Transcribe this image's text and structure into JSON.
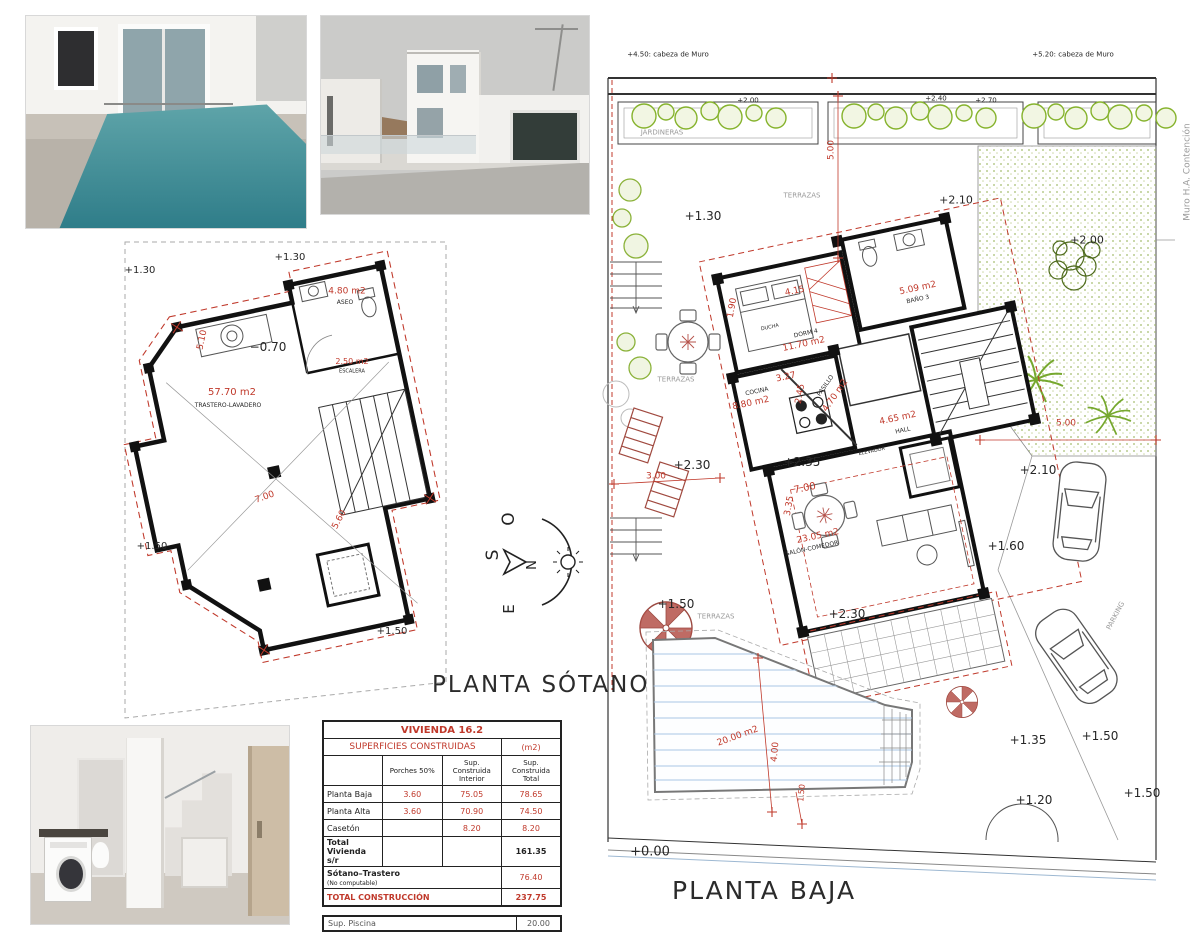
{
  "titles": {
    "sotano": "PLANTA SÓTANO",
    "baja": "PLANTA BAJA"
  },
  "compass": {
    "n": "N",
    "s": "S",
    "e": "E",
    "o": "O"
  },
  "colors": {
    "r": "#c0392b",
    "k": "#262626",
    "g2": "#9a9a9a"
  },
  "table": {
    "title": "VIVIENDA   16.2",
    "subtitle": "SUPERFICIES  CONSTRUIDAS",
    "subtitle_unit": "(m2)",
    "col_porches": "Porches  50%",
    "col_interior": "Sup. Construida Interior",
    "col_total": "Sup. Construida Total",
    "rows": [
      {
        "label": "Planta Baja",
        "porches": "3.60",
        "interior": "75.05",
        "total": "78.65"
      },
      {
        "label": "Planta Alta",
        "porches": "3.60",
        "interior": "70.90",
        "total": "74.50"
      },
      {
        "label": "Casetón",
        "porches": "",
        "interior": "8.20",
        "total": "8.20"
      }
    ],
    "total_vivienda_label": "Total Vivienda s/r",
    "total_vivienda_value": "161.35",
    "sotano_label": "Sótano–Trastero",
    "sotano_sublabel": "(No computable)",
    "sotano_value": "76.40",
    "total_label": "TOTAL  CONSTRUCCIÓN",
    "total_value": "237.75",
    "piscina_label": "Sup. Piscina",
    "piscina_value": "20.00",
    "footnote": "La vivienda ocupa sobre la parcela un área de 82.25 m2"
  },
  "sotano_labels": [
    {
      "t": "+1.30",
      "x": 140,
      "y": 271,
      "fs": 10
    },
    {
      "t": "+1.30",
      "x": 290,
      "y": 258,
      "fs": 10
    },
    {
      "t": "4.80 m2",
      "x": 347,
      "y": 292,
      "fs": 9,
      "c": "r"
    },
    {
      "t": "ASEO",
      "x": 345,
      "y": 303,
      "fs": 6
    },
    {
      "t": "−0.70",
      "x": 268,
      "y": 347,
      "fs": 12
    },
    {
      "t": "2.50 m2",
      "x": 352,
      "y": 362,
      "fs": 8,
      "c": "r"
    },
    {
      "t": "ESCALERA",
      "x": 352,
      "y": 372,
      "fs": 5
    },
    {
      "t": "5.10",
      "x": 203,
      "y": 340,
      "fs": 9,
      "c": "r",
      "rot": -78
    },
    {
      "t": "57.70 m2",
      "x": 232,
      "y": 393,
      "fs": 10,
      "c": "r"
    },
    {
      "t": "TRASTERO-LAVADERO",
      "x": 228,
      "y": 406,
      "fs": 6
    },
    {
      "t": "7.00",
      "x": 265,
      "y": 498,
      "fs": 9,
      "c": "r",
      "rot": -20
    },
    {
      "t": "5.60",
      "x": 340,
      "y": 520,
      "fs": 9,
      "c": "r",
      "rot": -62
    },
    {
      "t": "+1.50",
      "x": 152,
      "y": 547,
      "fs": 10
    },
    {
      "t": "+1.50",
      "x": 392,
      "y": 632,
      "fs": 10
    }
  ],
  "baja_labels": [
    {
      "t": "+4.50: cabeza de Muro",
      "x": 668,
      "y": 55,
      "fs": 7
    },
    {
      "t": "+5.20: cabeza de Muro",
      "x": 1073,
      "y": 55,
      "fs": 7
    },
    {
      "t": "+2.00",
      "x": 748,
      "y": 101,
      "fs": 7
    },
    {
      "t": "+2.40",
      "x": 936,
      "y": 99,
      "fs": 7
    },
    {
      "t": "+2.70",
      "x": 986,
      "y": 101,
      "fs": 7
    },
    {
      "t": "JARDINERAS",
      "x": 662,
      "y": 133,
      "fs": 7,
      "c": "g2"
    },
    {
      "t": "5.00",
      "x": 832,
      "y": 150,
      "fs": 9,
      "c": "r",
      "rot": -90
    },
    {
      "t": "TERRAZAS",
      "x": 802,
      "y": 196,
      "fs": 7,
      "c": "g2"
    },
    {
      "t": "+2.10",
      "x": 956,
      "y": 200,
      "fs": 11
    },
    {
      "t": "+1.30",
      "x": 703,
      "y": 216,
      "fs": 12
    },
    {
      "t": "+2.00",
      "x": 1087,
      "y": 240,
      "fs": 11
    },
    {
      "t": "1.90",
      "x": 733,
      "y": 308,
      "fs": 9,
      "c": "r",
      "rot": -80
    },
    {
      "t": "4.15",
      "x": 795,
      "y": 292,
      "fs": 9,
      "c": "r",
      "rot": -12
    },
    {
      "t": "DUCHA",
      "x": 770,
      "y": 328,
      "fs": 5,
      "rot": -12
    },
    {
      "t": "DORM 4",
      "x": 806,
      "y": 334,
      "fs": 6,
      "rot": -12
    },
    {
      "t": "11.70 m2",
      "x": 804,
      "y": 345,
      "fs": 9,
      "c": "r",
      "rot": -12
    },
    {
      "t": "5.09 m2",
      "x": 918,
      "y": 289,
      "fs": 9,
      "c": "r",
      "rot": -12
    },
    {
      "t": "BAÑO 3",
      "x": 918,
      "y": 300,
      "fs": 6,
      "rot": -12
    },
    {
      "t": "3.27",
      "x": 786,
      "y": 378,
      "fs": 9,
      "c": "r",
      "rot": -12
    },
    {
      "t": "COCINA",
      "x": 757,
      "y": 392,
      "fs": 6,
      "rot": -12
    },
    {
      "t": "8.80 m2",
      "x": 751,
      "y": 404,
      "fs": 9,
      "c": "r",
      "rot": -12
    },
    {
      "t": "2.45",
      "x": 801,
      "y": 394,
      "fs": 9,
      "c": "r",
      "rot": -80
    },
    {
      "t": "PASILLO",
      "x": 826,
      "y": 386,
      "fs": 6,
      "rot": -55
    },
    {
      "t": "4.70 m2",
      "x": 836,
      "y": 396,
      "fs": 9,
      "c": "r",
      "rot": -55
    },
    {
      "t": "4.65 m2",
      "x": 898,
      "y": 419,
      "fs": 9,
      "c": "r",
      "rot": -12
    },
    {
      "t": "HALL",
      "x": 903,
      "y": 431,
      "fs": 6,
      "rot": -12
    },
    {
      "t": "ELEVADOR",
      "x": 872,
      "y": 452,
      "fs": 5,
      "rot": -12
    },
    {
      "t": "TERRAZAS",
      "x": 676,
      "y": 380,
      "fs": 7,
      "c": "g2"
    },
    {
      "t": "3.00",
      "x": 656,
      "y": 477,
      "fs": 9,
      "c": "r"
    },
    {
      "t": "+2.30",
      "x": 692,
      "y": 465,
      "fs": 12
    },
    {
      "t": "+2.35",
      "x": 802,
      "y": 462,
      "fs": 12
    },
    {
      "t": "7.00",
      "x": 805,
      "y": 489,
      "fs": 10,
      "c": "r",
      "rot": -12
    },
    {
      "t": "3.35",
      "x": 790,
      "y": 506,
      "fs": 9,
      "c": "r",
      "rot": -80
    },
    {
      "t": "23.05 m2",
      "x": 818,
      "y": 537,
      "fs": 9,
      "c": "r",
      "rot": -12
    },
    {
      "t": "SALÓN-COMEDOR",
      "x": 812,
      "y": 549,
      "fs": 6,
      "rot": -12
    },
    {
      "t": "+1.60",
      "x": 1006,
      "y": 546,
      "fs": 12
    },
    {
      "t": "5.00",
      "x": 1066,
      "y": 424,
      "fs": 9,
      "c": "r"
    },
    {
      "t": "+2.10",
      "x": 1038,
      "y": 470,
      "fs": 12
    },
    {
      "t": "PARKING",
      "x": 1116,
      "y": 616,
      "fs": 7,
      "c": "g2",
      "rot": -62
    },
    {
      "t": "+1.50",
      "x": 676,
      "y": 604,
      "fs": 12
    },
    {
      "t": "TERRAZAS",
      "x": 716,
      "y": 617,
      "fs": 7,
      "c": "g2"
    },
    {
      "t": "+2.30",
      "x": 847,
      "y": 614,
      "fs": 12
    },
    {
      "t": "20.00 m2",
      "x": 738,
      "y": 737,
      "fs": 9,
      "c": "r",
      "rot": -20
    },
    {
      "t": "4.00",
      "x": 776,
      "y": 752,
      "fs": 9,
      "c": "r",
      "rot": -85
    },
    {
      "t": "1.50",
      "x": 802,
      "y": 793,
      "fs": 8,
      "c": "r",
      "rot": -85
    },
    {
      "t": "+1.35",
      "x": 1028,
      "y": 740,
      "fs": 12
    },
    {
      "t": "+1.50",
      "x": 1100,
      "y": 736,
      "fs": 12
    },
    {
      "t": "+1.20",
      "x": 1034,
      "y": 800,
      "fs": 12
    },
    {
      "t": "+1.50",
      "x": 1142,
      "y": 793,
      "fs": 12
    },
    {
      "t": "+0.00",
      "x": 650,
      "y": 852,
      "fs": 13
    },
    {
      "t": "Muro H.A. Contención",
      "x": 1188,
      "y": 172,
      "fs": 9,
      "c": "g2",
      "rot": -90
    }
  ]
}
